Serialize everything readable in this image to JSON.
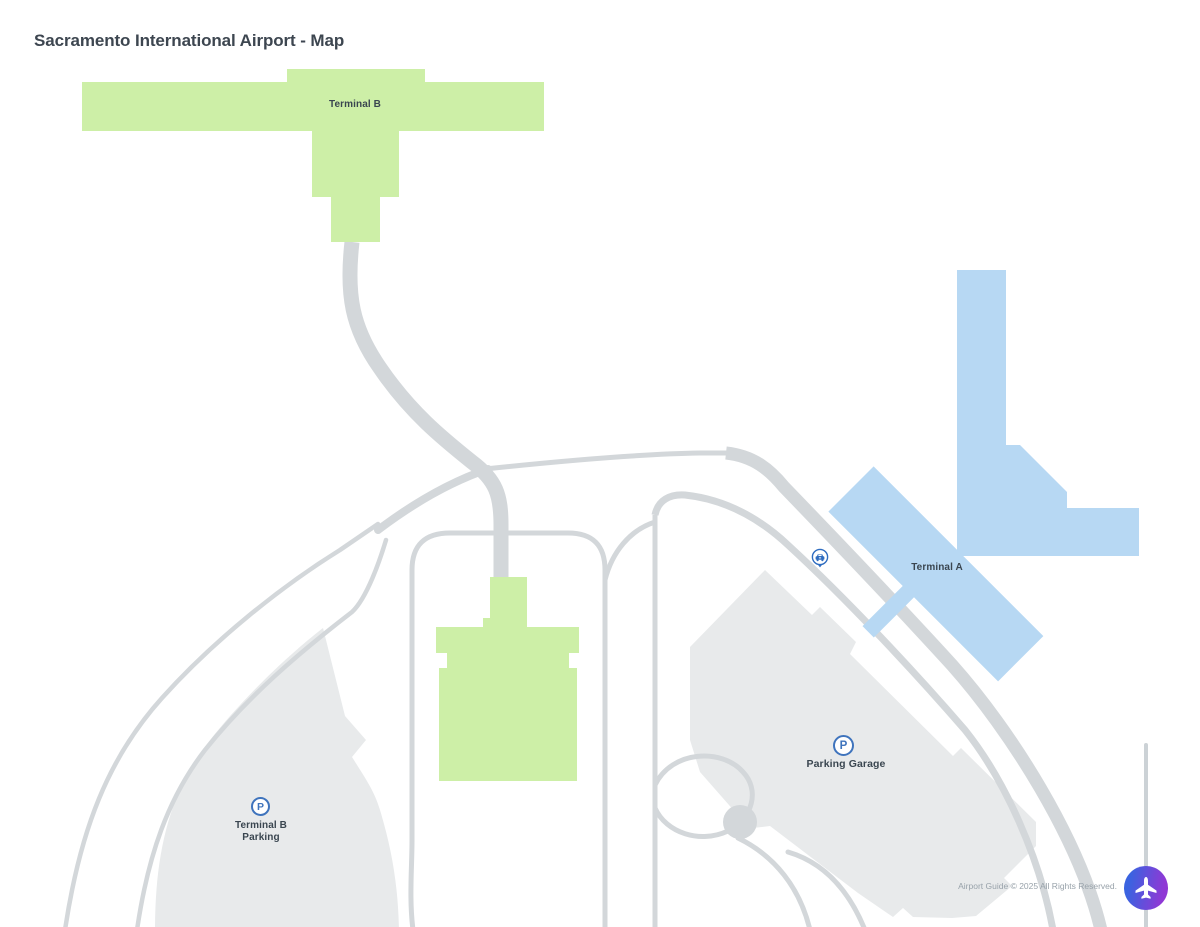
{
  "title": "Sacramento International Airport - Map",
  "map": {
    "labels": {
      "terminal_b": "Terminal B",
      "terminal_a": "Terminal A",
      "parking_garage": "Parking Garage",
      "terminal_b_parking_line1": "Terminal B",
      "terminal_b_parking_line2": "Parking",
      "parking_symbol": "P"
    },
    "markers": {
      "parking_garage_marker": "parking",
      "terminal_b_parking_marker": "parking",
      "ground_transport_marker": "car"
    },
    "colors": {
      "terminal_green": "#cdefa7",
      "terminal_blue": "#b7d8f3",
      "parking_gray": "#e8eaeb",
      "road_gray": "#d3d7da",
      "road_gray_light": "#ccd2d6",
      "label_text": "#3a4650",
      "title_color": "#3d4650",
      "footer_color": "#98a2aa",
      "parking_icon_blue": "#3f74bd",
      "car_icon_blue": "#2e6cc0",
      "plane_grad_a": "#3a63e0",
      "plane_grad_b": "#9038d5"
    }
  },
  "footer": {
    "copyright": "Airport Guide © 2025 All Rights Reserved."
  }
}
